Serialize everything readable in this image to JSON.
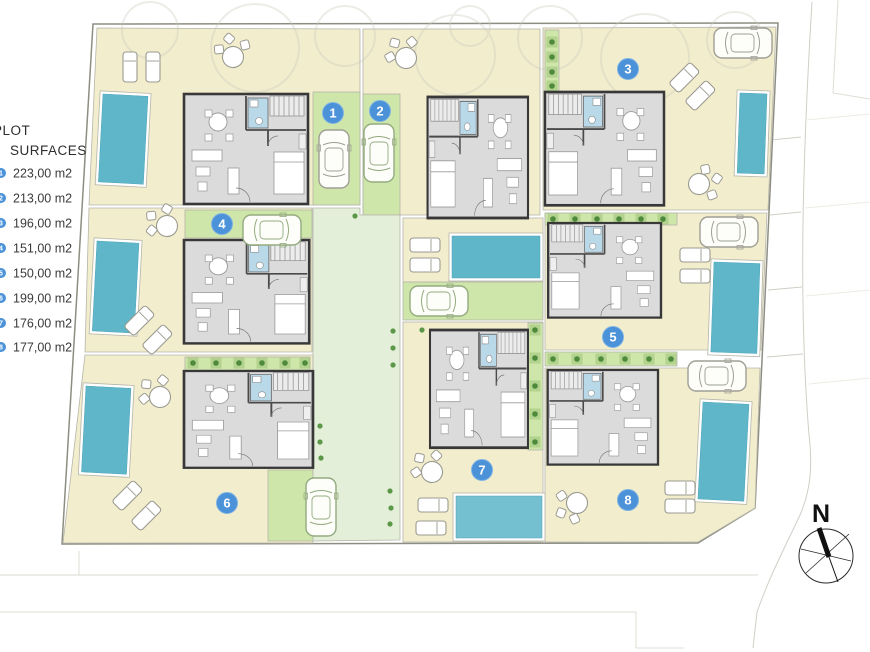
{
  "legend": {
    "title_line1": "PLOT",
    "title_line2": "SURFACES"
  },
  "plots": [
    {
      "number": "1",
      "area": "223,00 m2"
    },
    {
      "number": "2",
      "area": "213,00 m2"
    },
    {
      "number": "3",
      "area": "196,00 m2"
    },
    {
      "number": "4",
      "area": "151,00 m2"
    },
    {
      "number": "5",
      "area": "150,00 m2"
    },
    {
      "number": "6",
      "area": "199,00 m2"
    },
    {
      "number": "7",
      "area": "176,00 m2"
    },
    {
      "number": "8",
      "area": "177,00 m2"
    }
  ],
  "compass": {
    "label": "N"
  },
  "colors": {
    "plot_fill": "#f2edcd",
    "driveway_green": "#cfe6ab",
    "walkway_green": "#e4efd9",
    "pool_blue": "#5fb6c9",
    "badge_blue": "#4b92d8",
    "villa_floor": "#dbdbdb",
    "bathroom_blue": "#b9d9e9"
  }
}
